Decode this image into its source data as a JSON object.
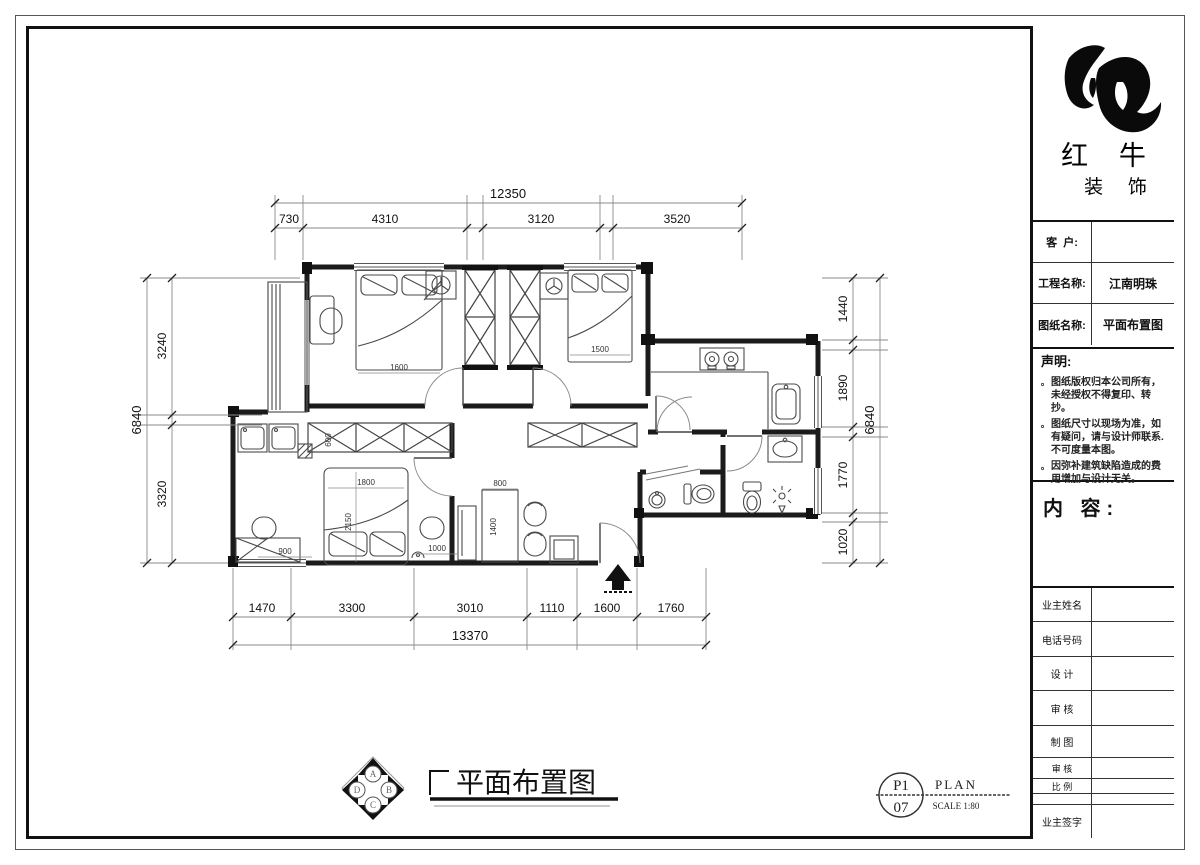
{
  "brand": {
    "line1": "红 牛",
    "line2": "装 饰"
  },
  "info_fields": {
    "client_label": "客  户:",
    "client_value": "",
    "project_label": "工程名称:",
    "project_value": "江南明珠",
    "sheet_label": "图纸名称:",
    "sheet_value": "平面布置图"
  },
  "statement": {
    "title": "声明:",
    "bullet": "。",
    "items": [
      "图纸版权归本公司所有，未经授权不得复印、转抄。",
      "图纸尺寸以现场为准，如有疑问，请与设计师联系.不可度量本图。",
      "因弥补建筑缺陷造成的费用增加与设计无关。"
    ]
  },
  "content_section": {
    "label": "内 容:"
  },
  "signoff_rows": [
    "业主姓名",
    "电话号码",
    "设 计",
    "审 核",
    "制 图",
    "审 核",
    "比 例",
    "业主签字"
  ],
  "drawing_title": {
    "title": "平面布置图",
    "compass": {
      "a": "A",
      "b": "B",
      "c": "C",
      "d": "D"
    }
  },
  "sheet_mark": {
    "top": "P1",
    "bottom": "07",
    "name": "PLAN",
    "scale": "SCALE 1:80"
  },
  "dims": {
    "top": {
      "overall": "12350",
      "segs": [
        "730",
        "4310",
        "3120",
        "3520"
      ]
    },
    "bottom": {
      "overall": "13370",
      "segs": [
        "1470",
        "3300",
        "3010",
        "1110",
        "1600",
        "1760"
      ]
    },
    "left": {
      "overall": "6840",
      "segs": [
        "3240",
        "3320"
      ]
    },
    "right": {
      "overall": "6840",
      "segs": [
        "1440",
        "1890",
        "1770",
        "1020"
      ]
    }
  },
  "plan_labels": {
    "bed1": "1600",
    "bed2": "1500",
    "bed3_w": "1800",
    "bed3_l": "2150",
    "wardrobe_d": "600",
    "desk_w": "900",
    "nightstand": "1000",
    "table_w": "800",
    "table_l": "1400"
  }
}
